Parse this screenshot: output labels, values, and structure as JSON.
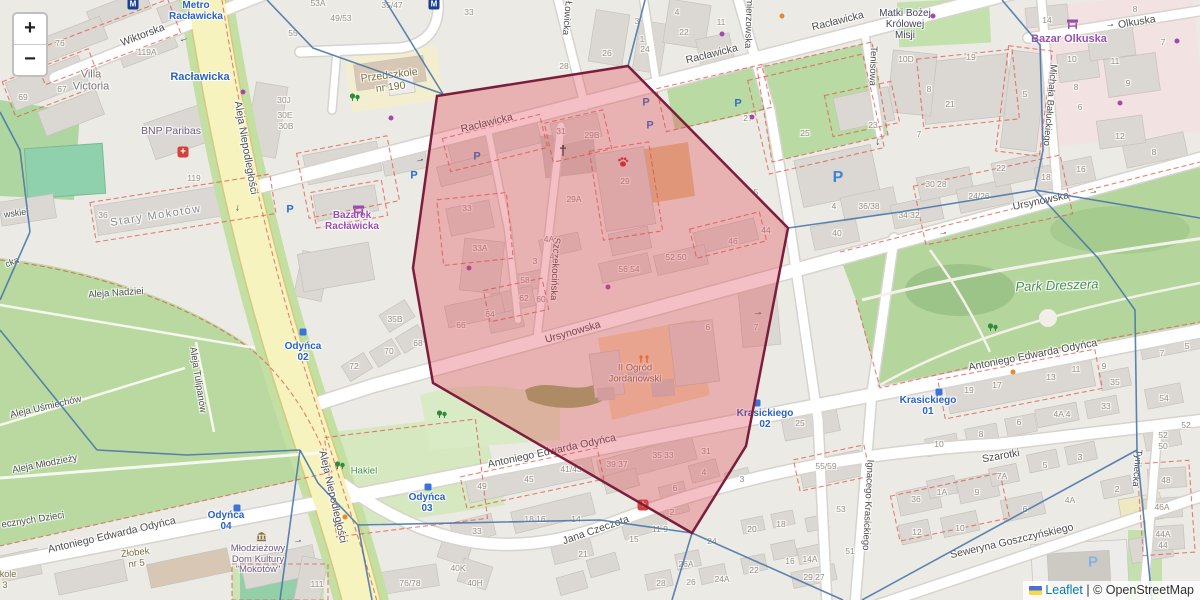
{
  "controls": {
    "zoom_in": "+",
    "zoom_out": "−"
  },
  "attribution": {
    "leaflet": "Leaflet",
    "separator": " | ",
    "copyright": "© OpenStreetMap"
  },
  "colors": {
    "selection_fill": "#e0404f",
    "selection_stroke": "#7b1e3c",
    "voronoi_line": "#4a78a8",
    "artery_yellow": "#f6f3bf",
    "park_green": "#bcdba6",
    "transit_blue": "#2a62c4",
    "retail_purple": "#9a4dae"
  },
  "selection": {
    "polygon": "437,96 628,66 788,228 746,446 692,533 433,383 413,268",
    "voronoi_edges": [
      "267,0 313,48 443,94",
      "385,0 443,94",
      "628,66 645,0",
      "788,228 900,212 1035,190",
      "1035,190 1043,150 1040,45 1002,0",
      "1035,190 1200,218",
      "1035,190 1098,258 1135,310 1137,450",
      "1137,450 1152,600",
      "1137,450 862,600",
      "692,533 843,600",
      "692,533 672,600",
      "692,533 600,520 358,525",
      "358,525 372,600",
      "358,525 318,483 300,450",
      "300,450 280,600",
      "300,450 187,455 97,450",
      "97,450 0,330",
      "0,112 20,150 30,232",
      "30,232 0,300"
    ]
  },
  "labels": [
    {
      "t": "Wiktorska",
      "x": 143,
      "y": 36,
      "r": -21,
      "c": "st"
    },
    {
      "t": "Racławicka",
      "x": 487,
      "y": 124,
      "r": -14,
      "c": "st"
    },
    {
      "t": "Racławicka",
      "x": 712,
      "y": 55,
      "r": -14,
      "c": "st"
    },
    {
      "t": "Racławicka",
      "x": 838,
      "y": 22,
      "r": -14,
      "c": "st"
    },
    {
      "t": "Ursynowska",
      "x": 573,
      "y": 333,
      "r": -16,
      "c": "st"
    },
    {
      "t": "Ursynowska",
      "x": 1041,
      "y": 202,
      "r": -12,
      "c": "st"
    },
    {
      "t": "Aleja Niepodległości",
      "x": 245,
      "y": 148,
      "r": 80,
      "c": "st"
    },
    {
      "t": "Aleja Niepodległości",
      "x": 332,
      "y": 497,
      "r": 77,
      "c": "st"
    },
    {
      "t": "Antoniego Edwarda Odyńca",
      "x": 112,
      "y": 536,
      "r": -13,
      "c": "st"
    },
    {
      "t": "Antoniego Edwarda Odyńca",
      "x": 552,
      "y": 452,
      "r": -12,
      "c": "st"
    },
    {
      "t": "Antoniego Edwarda Odyńca",
      "x": 1033,
      "y": 356,
      "r": -11,
      "c": "st"
    },
    {
      "t": "Jana Czeczota",
      "x": 596,
      "y": 531,
      "r": -19,
      "c": "st"
    },
    {
      "t": "Szarotki",
      "x": 1001,
      "y": 457,
      "r": -10,
      "c": "st"
    },
    {
      "t": "Seweryna Goszczyńskiego",
      "x": 1012,
      "y": 542,
      "r": -13,
      "c": "st"
    },
    {
      "t": "Szczekocińska",
      "x": 554,
      "y": 269,
      "r": 93,
      "c": "st",
      "s": 9.5
    },
    {
      "t": "Łowicka",
      "x": 566,
      "y": 18,
      "r": 95,
      "c": "st",
      "s": 9.5
    },
    {
      "t": "Kazimierzowska",
      "x": 748,
      "y": 14,
      "r": 92,
      "c": "st",
      "s": 9.5
    },
    {
      "t": "Tenisowa",
      "x": 872,
      "y": 66,
      "r": 92,
      "c": "st",
      "s": 9.5
    },
    {
      "t": "Michała Bałuckiego",
      "x": 1049,
      "y": 105,
      "r": 95,
      "c": "st",
      "s": 9.5
    },
    {
      "t": "Ignacego Krasickiego",
      "x": 867,
      "y": 505,
      "r": 93,
      "c": "st",
      "s": 9.5
    },
    {
      "t": "Tyniecka",
      "x": 1136,
      "y": 468,
      "r": 95,
      "c": "st",
      "s": 9.5
    },
    {
      "t": "Olkuska",
      "x": 1137,
      "y": 23,
      "r": -9,
      "c": "st"
    },
    {
      "t": "Stary Mokotów",
      "x": 156,
      "y": 216,
      "r": -9,
      "c": "hood"
    },
    {
      "t": "Aleja Nadziei",
      "x": 116,
      "y": 294,
      "r": -4,
      "c": "st",
      "s": 9.5
    },
    {
      "t": "Aleja Uśmiechów",
      "x": 46,
      "y": 408,
      "r": -13,
      "c": "st",
      "s": 9.5
    },
    {
      "t": "Aleja Tulipanów",
      "x": 197,
      "y": 380,
      "r": 81,
      "c": "st",
      "s": 9.5
    },
    {
      "t": "Aleja Młodzieży",
      "x": 45,
      "y": 465,
      "r": -11,
      "c": "st",
      "s": 9.5
    },
    {
      "t": "ecznych Dzieci",
      "x": 33,
      "y": 521,
      "r": -9,
      "c": "st",
      "s": 9.5
    },
    {
      "t": "wskiej",
      "x": 16,
      "y": 213,
      "r": -8,
      "c": "st",
      "s": 9
    },
    {
      "t": "cka",
      "x": 12,
      "y": 262,
      "r": -22,
      "c": "st",
      "s": 9
    },
    {
      "t": "Metro\nRacławicka",
      "x": 196,
      "y": 11,
      "r": 0,
      "c": "tr"
    },
    {
      "t": "Racławicka",
      "x": 200,
      "y": 77,
      "r": 0,
      "c": "tr",
      "s": 11
    },
    {
      "t": "Odyńca\n02",
      "x": 303,
      "y": 352,
      "r": 0,
      "c": "tr"
    },
    {
      "t": "Odyńca\n03",
      "x": 427,
      "y": 503,
      "r": 0,
      "c": "tr"
    },
    {
      "t": "Odyńca\n04",
      "x": 226,
      "y": 521,
      "r": 0,
      "c": "tr"
    },
    {
      "t": "Krasickiego\n01",
      "x": 928,
      "y": 406,
      "r": 0,
      "c": "tr"
    },
    {
      "t": "Krasickiego\n02",
      "x": 765,
      "y": 419,
      "r": 0,
      "c": "tr"
    },
    {
      "t": "Bazarek\nRacławicka",
      "x": 352,
      "y": 221,
      "r": 0,
      "c": "rt"
    },
    {
      "t": "Bazar Olkuska",
      "x": 1069,
      "y": 39,
      "r": 0,
      "c": "rt",
      "s": 11
    },
    {
      "t": "BNP Paribas",
      "x": 171,
      "y": 132,
      "r": 0,
      "c": "am",
      "s": 10.5
    },
    {
      "t": "Park Dreszera",
      "x": 1057,
      "y": 286,
      "r": -2,
      "c": "pk"
    },
    {
      "t": "Hakiel",
      "x": 364,
      "y": 472,
      "r": 0,
      "c": "grn"
    },
    {
      "t": "Przedszkole\nnr 190",
      "x": 390,
      "y": 82,
      "r": -7,
      "c": "sch",
      "s": 10.5
    },
    {
      "t": "II Ogród\nJordanowski",
      "x": 635,
      "y": 374,
      "r": 0,
      "c": "sch"
    },
    {
      "t": "Żłobek\nnr 5",
      "x": 136,
      "y": 559,
      "r": -7,
      "c": "sch"
    },
    {
      "t": "kole",
      "x": 8,
      "y": 574,
      "r": 0,
      "c": "sch",
      "s": 9
    },
    {
      "t": "3",
      "x": 5,
      "y": 585,
      "r": 0,
      "c": "sch",
      "s": 9
    },
    {
      "t": "Młodzieżowy\nDom Kultury\n\"Mokotów\"",
      "x": 258,
      "y": 560,
      "r": 0,
      "c": "am"
    },
    {
      "t": "Matki Bożej\nKrólowej\nMisji",
      "x": 905,
      "y": 25,
      "r": 0,
      "c": "chu"
    },
    {
      "t": "Villa\nVictoria",
      "x": 91,
      "y": 81,
      "r": 0,
      "c": "pl",
      "s": 11
    }
  ],
  "house_numbers": [
    [
      "76",
      60,
      44
    ],
    [
      "119A",
      147,
      53
    ],
    [
      "67",
      62,
      90
    ],
    [
      "69",
      23,
      98
    ],
    [
      "55",
      293,
      34
    ],
    [
      "53A",
      318,
      4
    ],
    [
      "49/53",
      341,
      19
    ],
    [
      "35/47",
      392,
      6
    ],
    [
      "33",
      469,
      13
    ],
    [
      "30J",
      284,
      101
    ],
    [
      "30E",
      285,
      116
    ],
    [
      "30B",
      286,
      127
    ],
    [
      "119",
      194,
      179
    ],
    [
      "36",
      103,
      216
    ],
    [
      "4",
      677,
      13
    ],
    [
      "22",
      684,
      33
    ],
    [
      "11",
      721,
      23
    ],
    [
      "3",
      637,
      22
    ],
    [
      "1",
      642,
      40
    ],
    [
      "24",
      645,
      50
    ],
    [
      "26",
      607,
      54
    ],
    [
      "28",
      564,
      67
    ],
    [
      "27",
      748,
      119
    ],
    [
      "25",
      805,
      134
    ],
    [
      "23",
      873,
      126
    ],
    [
      "31",
      561,
      132
    ],
    [
      "29B",
      592,
      136
    ],
    [
      "29A",
      574,
      200
    ],
    [
      "29",
      625,
      182
    ],
    [
      "33",
      467,
      209
    ],
    [
      "33A",
      480,
      249
    ],
    [
      "4A",
      549,
      240
    ],
    [
      "4",
      552,
      257
    ],
    [
      "3",
      535,
      262
    ],
    [
      "58",
      525,
      281
    ],
    [
      "62",
      524,
      299
    ],
    [
      "60",
      541,
      300
    ],
    [
      "56 54",
      629,
      270
    ],
    [
      "52 50",
      676,
      258
    ],
    [
      "46",
      733,
      242
    ],
    [
      "44",
      766,
      231
    ],
    [
      "5",
      756,
      193
    ],
    [
      "66",
      461,
      326
    ],
    [
      "64",
      490,
      315
    ],
    [
      "68",
      418,
      344
    ],
    [
      "70",
      389,
      352
    ],
    [
      "72",
      354,
      367
    ],
    [
      "35B",
      395,
      320
    ],
    [
      "6",
      708,
      328
    ],
    [
      "7",
      756,
      328
    ],
    [
      "19",
      971,
      58
    ],
    [
      "21",
      950,
      105
    ],
    [
      "10D",
      906,
      60
    ],
    [
      "8",
      929,
      90
    ],
    [
      "7",
      919,
      135
    ],
    [
      "5",
      1025,
      95
    ],
    [
      "14",
      1047,
      21
    ],
    [
      "8",
      1135,
      10
    ],
    [
      "10",
      1072,
      60
    ],
    [
      "11",
      1115,
      62
    ],
    [
      "9",
      1128,
      84
    ],
    [
      "7",
      1163,
      43
    ],
    [
      "12",
      1120,
      137
    ],
    [
      "8",
      1076,
      88
    ],
    [
      "6",
      1080,
      108
    ],
    [
      "22",
      1001,
      169
    ],
    [
      "30 28",
      936,
      185
    ],
    [
      "24/26",
      979,
      197
    ],
    [
      "34 32",
      909,
      216
    ],
    [
      "18",
      1046,
      178
    ],
    [
      "16",
      1081,
      170
    ],
    [
      "8",
      1154,
      153
    ],
    [
      "36/38",
      869,
      207
    ],
    [
      "40",
      837,
      234
    ],
    [
      "4",
      834,
      207
    ],
    [
      "25",
      800,
      424
    ],
    [
      "53",
      841,
      510
    ],
    [
      "51",
      850,
      552
    ],
    [
      "55/59",
      826,
      467
    ],
    [
      "5",
      1187,
      347
    ],
    [
      "7",
      1162,
      354
    ],
    [
      "54",
      1164,
      399
    ],
    [
      "52",
      1186,
      426
    ],
    [
      "52",
      1163,
      436
    ],
    [
      "50",
      1163,
      447
    ],
    [
      "19",
      969,
      391
    ],
    [
      "17",
      997,
      386
    ],
    [
      "13",
      1051,
      378
    ],
    [
      "11",
      1076,
      370
    ],
    [
      "9",
      1104,
      367
    ],
    [
      "35",
      1115,
      383
    ],
    [
      "33",
      1106,
      407
    ],
    [
      "4A 4",
      1062,
      415
    ],
    [
      "6",
      1019,
      423
    ],
    [
      "8",
      981,
      435
    ],
    [
      "10",
      939,
      445
    ],
    [
      "111",
      317,
      585
    ],
    [
      "76/78",
      410,
      584
    ],
    [
      "40K",
      458,
      569
    ],
    [
      "40H",
      475,
      584
    ],
    [
      "49",
      482,
      487
    ],
    [
      "45",
      529,
      480
    ],
    [
      "41/43",
      571,
      470
    ],
    [
      "33",
      477,
      532
    ],
    [
      "18 16",
      535,
      520
    ],
    [
      "14",
      576,
      520
    ],
    [
      "21",
      583,
      555
    ],
    [
      "15",
      634,
      540
    ],
    [
      "11 9",
      660,
      530
    ],
    [
      "39 37",
      617,
      465
    ],
    [
      "35 33",
      663,
      456
    ],
    [
      "31",
      706,
      452
    ],
    [
      "4",
      704,
      473
    ],
    [
      "3",
      742,
      480
    ],
    [
      "6",
      675,
      489
    ],
    [
      "2",
      672,
      513
    ],
    [
      "26A",
      686,
      565
    ],
    [
      "26",
      691,
      583
    ],
    [
      "24",
      712,
      542
    ],
    [
      "24A",
      722,
      580
    ],
    [
      "22",
      754,
      571
    ],
    [
      "20",
      752,
      530
    ],
    [
      "18",
      781,
      525
    ],
    [
      "16",
      790,
      562
    ],
    [
      "14A",
      810,
      560
    ],
    [
      "28",
      661,
      584
    ],
    [
      "29 27",
      814,
      578
    ],
    [
      "36",
      916,
      500
    ],
    [
      "1A",
      942,
      493
    ],
    [
      "9",
      977,
      493
    ],
    [
      "7A",
      1002,
      477
    ],
    [
      "5",
      1045,
      466
    ],
    [
      "3",
      1080,
      458
    ],
    [
      "6",
      1025,
      510
    ],
    [
      "10",
      960,
      529
    ],
    [
      "12",
      917,
      533
    ],
    [
      "2",
      1117,
      490
    ],
    [
      "4A",
      1070,
      501
    ],
    [
      "48",
      1166,
      481
    ],
    [
      "46A",
      1162,
      508
    ],
    [
      "44A",
      1163,
      535
    ],
    [
      "44",
      1163,
      546
    ]
  ],
  "icons": [
    [
      "metro",
      133,
      4
    ],
    [
      "metro",
      434,
      4
    ],
    [
      "aid",
      183,
      152
    ],
    [
      "aid",
      643,
      505
    ],
    [
      "church",
      563,
      150
    ],
    [
      "paw",
      617,
      156
    ],
    [
      "museum",
      256,
      531
    ],
    [
      "market",
      352,
      204
    ],
    [
      "market",
      1066,
      18
    ],
    [
      "p",
      646,
      103
    ],
    [
      "p",
      650,
      126
    ],
    [
      "p",
      738,
      104
    ],
    [
      "p",
      477,
      157
    ],
    [
      "p",
      414,
      176
    ],
    [
      "p",
      290,
      210
    ],
    [
      "p",
      838,
      178,
      "lg"
    ],
    [
      "p",
      1093,
      562,
      "lt"
    ],
    [
      "play",
      637,
      355
    ],
    [
      "tree",
      349,
      92
    ],
    [
      "tree",
      436,
      409
    ],
    [
      "tree",
      987,
      322
    ],
    [
      "tree",
      334,
      460
    ],
    [
      "bus",
      303,
      332
    ],
    [
      "bus",
      428,
      487
    ],
    [
      "bus",
      237,
      508
    ],
    [
      "bus",
      939,
      392
    ],
    [
      "bus",
      757,
      403
    ],
    [
      "dot",
      243,
      92
    ],
    [
      "dot",
      391,
      118
    ],
    [
      "dot",
      722,
      34
    ],
    [
      "dot",
      752,
      117
    ],
    [
      "dot",
      1120,
      103
    ],
    [
      "dot",
      1177,
      41
    ],
    [
      "dot",
      933,
      16
    ],
    [
      "dot",
      608,
      287
    ],
    [
      "dot",
      469,
      268
    ],
    [
      "doto",
      1013,
      372
    ],
    [
      "doto",
      345,
      517
    ],
    [
      "doto",
      782,
      16
    ],
    [
      "arr",
      184,
      40,
      160
    ],
    [
      "arr",
      238,
      208,
      97
    ],
    [
      "arr",
      336,
      524,
      103
    ],
    [
      "arr",
      420,
      160,
      -14
    ],
    [
      "arr",
      943,
      233,
      -13
    ],
    [
      "arr",
      1093,
      192,
      -13
    ],
    [
      "arr",
      298,
      541,
      -12
    ],
    [
      "arr",
      1110,
      25,
      -8
    ],
    [
      "arr",
      878,
      142,
      88
    ],
    [
      "arr",
      758,
      313,
      -5
    ]
  ]
}
